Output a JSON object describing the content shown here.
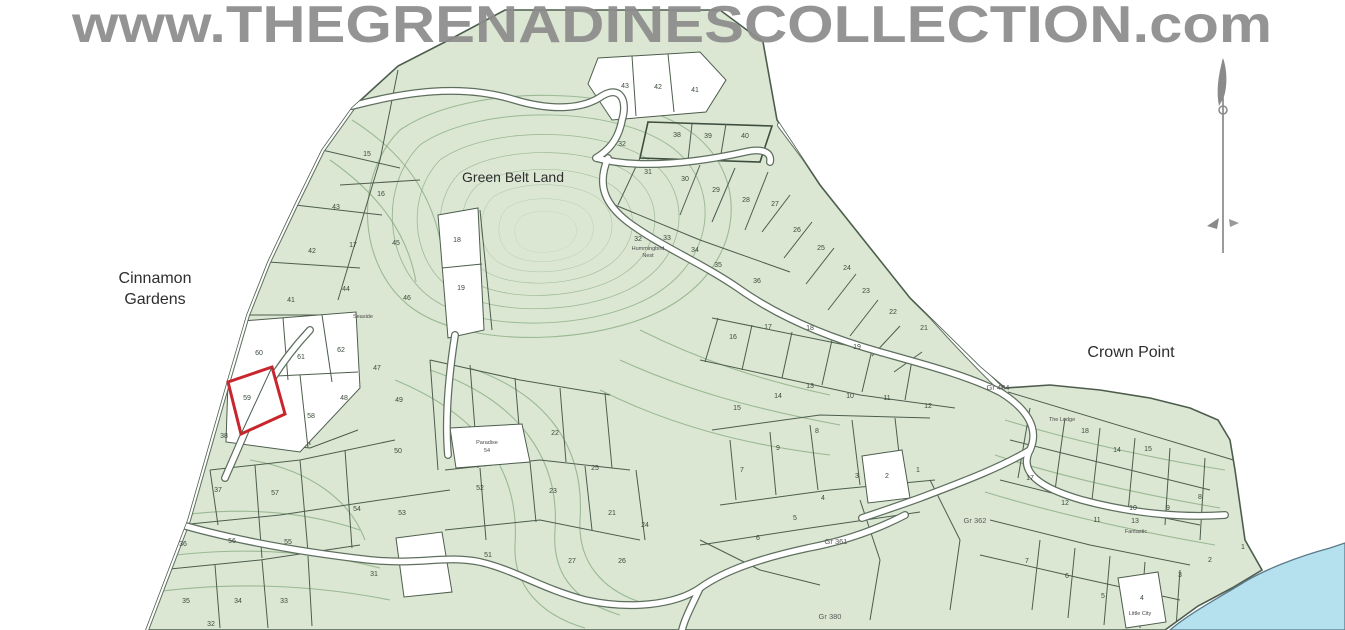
{
  "watermark": "www.THEGRENADINESCOLLECTION.com",
  "map": {
    "area_labels": [
      {
        "text": "Cinnamon",
        "x": 155,
        "y": 283,
        "size": 16
      },
      {
        "text": "Gardens",
        "x": 155,
        "y": 304,
        "size": 16
      },
      {
        "text": "Green Belt Land",
        "x": 513,
        "y": 182,
        "size": 14
      },
      {
        "text": "Crown Point",
        "x": 1131,
        "y": 357,
        "size": 16
      }
    ],
    "survey_refs": [
      {
        "text": "Gr 404",
        "x": 998,
        "y": 390
      },
      {
        "text": "Gr 362",
        "x": 975,
        "y": 523
      },
      {
        "text": "Gr 361",
        "x": 836,
        "y": 544
      },
      {
        "text": "Gr 380",
        "x": 830,
        "y": 619
      }
    ],
    "micro_labels": [
      {
        "text": "Seaside",
        "x": 363,
        "y": 318
      },
      {
        "text": "Hummingbird",
        "x": 648,
        "y": 250
      },
      {
        "text": "Nest",
        "x": 648,
        "y": 257
      },
      {
        "text": "Paradise",
        "x": 487,
        "y": 444
      },
      {
        "text": "54",
        "x": 487,
        "y": 452
      },
      {
        "text": "The Lodge",
        "x": 1062,
        "y": 421
      },
      {
        "text": "Fantastic",
        "x": 1136,
        "y": 533
      },
      {
        "text": "Little City",
        "x": 1140,
        "y": 615
      }
    ],
    "highlight_plot": {
      "number": "59",
      "color": "#c9252c"
    },
    "plot_numbers": [
      {
        "n": "15",
        "x": 367,
        "y": 156
      },
      {
        "n": "16",
        "x": 381,
        "y": 196
      },
      {
        "n": "43",
        "x": 336,
        "y": 209
      },
      {
        "n": "17",
        "x": 353,
        "y": 247
      },
      {
        "n": "42",
        "x": 312,
        "y": 253
      },
      {
        "n": "45",
        "x": 396,
        "y": 245
      },
      {
        "n": "18",
        "x": 457,
        "y": 242
      },
      {
        "n": "44",
        "x": 346,
        "y": 291
      },
      {
        "n": "41",
        "x": 291,
        "y": 302
      },
      {
        "n": "19",
        "x": 461,
        "y": 290
      },
      {
        "n": "46",
        "x": 407,
        "y": 300
      },
      {
        "n": "47",
        "x": 377,
        "y": 370
      },
      {
        "n": "48",
        "x": 344,
        "y": 400
      },
      {
        "n": "49",
        "x": 399,
        "y": 402
      },
      {
        "n": "50",
        "x": 398,
        "y": 453
      },
      {
        "n": "60",
        "x": 259,
        "y": 355
      },
      {
        "n": "61",
        "x": 301,
        "y": 359
      },
      {
        "n": "62",
        "x": 341,
        "y": 352
      },
      {
        "n": "59",
        "x": 247,
        "y": 400
      },
      {
        "n": "58",
        "x": 311,
        "y": 418
      },
      {
        "n": "38",
        "x": 224,
        "y": 438
      },
      {
        "n": "37",
        "x": 218,
        "y": 492
      },
      {
        "n": "36",
        "x": 183,
        "y": 546
      },
      {
        "n": "35",
        "x": 186,
        "y": 603
      },
      {
        "n": "34",
        "x": 238,
        "y": 603
      },
      {
        "n": "33",
        "x": 284,
        "y": 603
      },
      {
        "n": "32",
        "x": 211,
        "y": 626
      },
      {
        "n": "57",
        "x": 275,
        "y": 495
      },
      {
        "n": "56",
        "x": 232,
        "y": 543
      },
      {
        "n": "55",
        "x": 288,
        "y": 544
      },
      {
        "n": "54",
        "x": 357,
        "y": 511
      },
      {
        "n": "53",
        "x": 402,
        "y": 515
      },
      {
        "n": "52",
        "x": 480,
        "y": 490
      },
      {
        "n": "51",
        "x": 488,
        "y": 557
      },
      {
        "n": "31",
        "x": 374,
        "y": 576
      },
      {
        "n": "43",
        "x": 625,
        "y": 88
      },
      {
        "n": "42",
        "x": 658,
        "y": 89
      },
      {
        "n": "41",
        "x": 695,
        "y": 92
      },
      {
        "n": "38",
        "x": 677,
        "y": 137
      },
      {
        "n": "39",
        "x": 708,
        "y": 138
      },
      {
        "n": "40",
        "x": 745,
        "y": 138
      },
      {
        "n": "32",
        "x": 622,
        "y": 146
      },
      {
        "n": "31",
        "x": 648,
        "y": 174
      },
      {
        "n": "30",
        "x": 685,
        "y": 181
      },
      {
        "n": "29",
        "x": 716,
        "y": 192
      },
      {
        "n": "28",
        "x": 746,
        "y": 202
      },
      {
        "n": "27",
        "x": 775,
        "y": 206
      },
      {
        "n": "26",
        "x": 797,
        "y": 232
      },
      {
        "n": "25",
        "x": 821,
        "y": 250
      },
      {
        "n": "24",
        "x": 847,
        "y": 270
      },
      {
        "n": "23",
        "x": 866,
        "y": 293
      },
      {
        "n": "22",
        "x": 893,
        "y": 314
      },
      {
        "n": "21",
        "x": 924,
        "y": 330
      },
      {
        "n": "32",
        "x": 638,
        "y": 241
      },
      {
        "n": "33",
        "x": 667,
        "y": 240
      },
      {
        "n": "34",
        "x": 695,
        "y": 252
      },
      {
        "n": "35",
        "x": 718,
        "y": 267
      },
      {
        "n": "36",
        "x": 757,
        "y": 283
      },
      {
        "n": "16",
        "x": 733,
        "y": 339
      },
      {
        "n": "17",
        "x": 768,
        "y": 329
      },
      {
        "n": "18",
        "x": 810,
        "y": 330
      },
      {
        "n": "19",
        "x": 857,
        "y": 349
      },
      {
        "n": "22",
        "x": 555,
        "y": 435
      },
      {
        "n": "23",
        "x": 553,
        "y": 493
      },
      {
        "n": "25",
        "x": 595,
        "y": 470
      },
      {
        "n": "21",
        "x": 612,
        "y": 515
      },
      {
        "n": "27",
        "x": 572,
        "y": 563
      },
      {
        "n": "26",
        "x": 622,
        "y": 563
      },
      {
        "n": "24",
        "x": 645,
        "y": 527
      },
      {
        "n": "15",
        "x": 737,
        "y": 410
      },
      {
        "n": "14",
        "x": 778,
        "y": 398
      },
      {
        "n": "13",
        "x": 810,
        "y": 388
      },
      {
        "n": "10",
        "x": 850,
        "y": 398
      },
      {
        "n": "11",
        "x": 887,
        "y": 400
      },
      {
        "n": "12",
        "x": 928,
        "y": 408
      },
      {
        "n": "8",
        "x": 817,
        "y": 433
      },
      {
        "n": "9",
        "x": 778,
        "y": 450
      },
      {
        "n": "7",
        "x": 742,
        "y": 472
      },
      {
        "n": "3",
        "x": 857,
        "y": 478
      },
      {
        "n": "2",
        "x": 887,
        "y": 478
      },
      {
        "n": "1",
        "x": 918,
        "y": 472
      },
      {
        "n": "4",
        "x": 823,
        "y": 500
      },
      {
        "n": "5",
        "x": 795,
        "y": 520
      },
      {
        "n": "6",
        "x": 758,
        "y": 540
      },
      {
        "n": "18",
        "x": 1085,
        "y": 433
      },
      {
        "n": "14",
        "x": 1117,
        "y": 452
      },
      {
        "n": "15",
        "x": 1148,
        "y": 451
      },
      {
        "n": "17",
        "x": 1030,
        "y": 480
      },
      {
        "n": "12",
        "x": 1065,
        "y": 505
      },
      {
        "n": "10",
        "x": 1133,
        "y": 510
      },
      {
        "n": "11",
        "x": 1097,
        "y": 522
      },
      {
        "n": "13",
        "x": 1135,
        "y": 523
      },
      {
        "n": "9",
        "x": 1168,
        "y": 510
      },
      {
        "n": "8",
        "x": 1200,
        "y": 499
      },
      {
        "n": "7",
        "x": 1027,
        "y": 563
      },
      {
        "n": "6",
        "x": 1067,
        "y": 578
      },
      {
        "n": "5",
        "x": 1103,
        "y": 598
      },
      {
        "n": "4",
        "x": 1142,
        "y": 600
      },
      {
        "n": "3",
        "x": 1180,
        "y": 577
      },
      {
        "n": "2",
        "x": 1210,
        "y": 562
      },
      {
        "n": "1",
        "x": 1243,
        "y": 549
      }
    ],
    "colors": {
      "land": "#dbe7d3",
      "water": "#b5e1ef",
      "road": "#ffffff",
      "parcel_line": "#4d5d4d",
      "contour": "#85a97f",
      "highlight": "#c9252c",
      "watermark": "#8c8c8c",
      "label": "#2e2e2e"
    },
    "compass": {
      "name": "north-arrow"
    }
  }
}
